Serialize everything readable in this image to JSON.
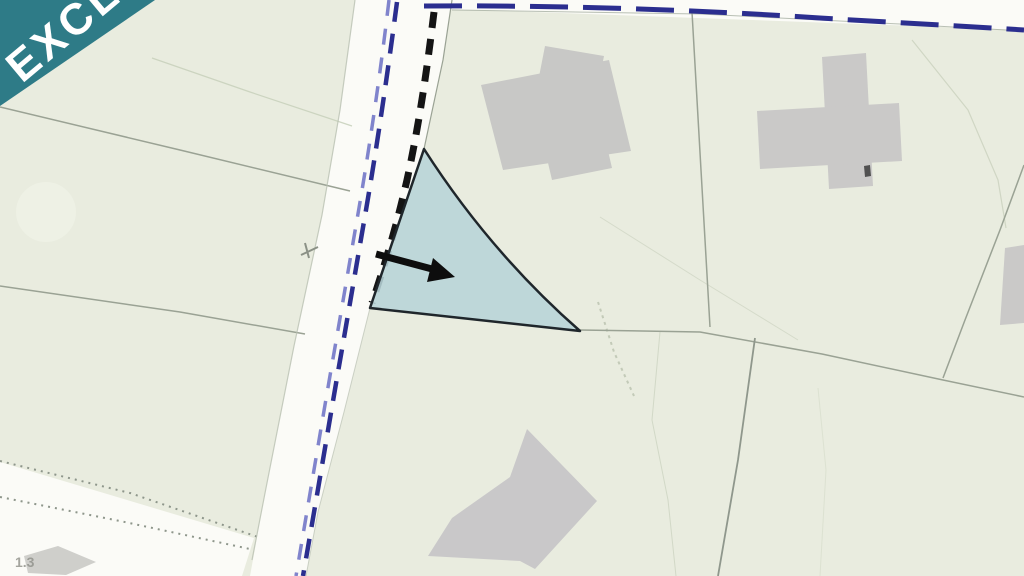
{
  "banner": {
    "label": "EXCL",
    "bg_color": "#2e7b87",
    "text_color": "#ffffff"
  },
  "map": {
    "viewbox": [
      0,
      0,
      1024,
      576
    ],
    "colors": {
      "land": "#e9ecdf",
      "road": "#fbfbf7",
      "building": "#c8c8c6",
      "parcel_highlight_fill": "#b7d4d8",
      "parcel_highlight_stroke": "#1f262b",
      "boundary_line": "#9aa294",
      "contour_line": "#c9d1bd",
      "route_blue_dark": "#2b2e8f",
      "route_blue_light": "#8084cc",
      "route_black": "#141414"
    },
    "corner_label": "1.3",
    "features": [
      {
        "name": "land-base",
        "kind": "polygon",
        "pts": [
          [
            0,
            0
          ],
          [
            1024,
            0
          ],
          [
            1024,
            576
          ],
          [
            0,
            576
          ]
        ],
        "f": "#e9ecdf"
      },
      {
        "name": "contour-blob",
        "kind": "circle",
        "cx": 46,
        "cy": 212,
        "r": 30,
        "f": "#eef1e5"
      },
      {
        "name": "road-main",
        "kind": "polygon",
        "pts": [
          [
            355,
            0
          ],
          [
            452,
            0
          ],
          [
            443,
            60
          ],
          [
            424,
            149
          ],
          [
            370,
            308
          ],
          [
            344,
            412
          ],
          [
            318,
            512
          ],
          [
            306,
            576
          ],
          [
            250,
            576
          ],
          [
            266,
            488
          ],
          [
            294,
            346
          ],
          [
            322,
            215
          ],
          [
            340,
            110
          ]
        ],
        "f": "#fbfbf7"
      },
      {
        "name": "road-branch",
        "kind": "polygon",
        "pts": [
          [
            0,
            462
          ],
          [
            254,
            538
          ],
          [
            242,
            576
          ],
          [
            0,
            576
          ]
        ],
        "f": "#fbfbf7"
      },
      {
        "name": "road-top-strip",
        "kind": "polygon",
        "pts": [
          [
            420,
            0
          ],
          [
            1024,
            0
          ],
          [
            1024,
            30
          ],
          [
            424,
            8
          ]
        ],
        "f": "#fbfbf7"
      },
      {
        "name": "contour-line-a",
        "kind": "polyline",
        "pts": [
          [
            152,
            58
          ],
          [
            250,
            92
          ],
          [
            352,
            126
          ]
        ],
        "s": "#c9d1bd",
        "w": 1.2,
        "o": 0.9
      },
      {
        "name": "contour-line-b",
        "kind": "polyline",
        "pts": [
          [
            600,
            217
          ],
          [
            700,
            280
          ],
          [
            798,
            340
          ]
        ],
        "s": "#ccd3c0",
        "w": 1,
        "o": 0.7
      },
      {
        "name": "contour-line-c",
        "kind": "polyline",
        "pts": [
          [
            912,
            40
          ],
          [
            968,
            110
          ],
          [
            998,
            180
          ],
          [
            1006,
            228
          ]
        ],
        "s": "#c9d1bd",
        "w": 1.2,
        "o": 0.8
      },
      {
        "name": "contour-line-d",
        "kind": "polyline",
        "pts": [
          [
            660,
            332
          ],
          [
            652,
            420
          ],
          [
            668,
            500
          ],
          [
            676,
            576
          ]
        ],
        "s": "#ccd3c0",
        "w": 1,
        "o": 0.8
      },
      {
        "name": "contour-hachure",
        "kind": "polyline",
        "pts": [
          [
            598,
            302
          ],
          [
            614,
            352
          ],
          [
            634,
            396
          ]
        ],
        "s": "#b9c2ae",
        "w": 2,
        "d": "3 4",
        "o": 0.8
      },
      {
        "name": "contour-line-e",
        "kind": "polyline",
        "pts": [
          [
            818,
            388
          ],
          [
            826,
            470
          ],
          [
            820,
            576
          ]
        ],
        "s": "#d4dac8",
        "w": 1,
        "o": 0.6
      },
      {
        "name": "boundary-left-upper",
        "kind": "polyline",
        "pts": [
          [
            0,
            107
          ],
          [
            180,
            150
          ],
          [
            350,
            191
          ]
        ],
        "s": "#9aa294",
        "w": 1.5
      },
      {
        "name": "boundary-left-lower",
        "kind": "polyline",
        "pts": [
          [
            0,
            286
          ],
          [
            180,
            312
          ],
          [
            305,
            334
          ]
        ],
        "s": "#9aa294",
        "w": 1.5
      },
      {
        "name": "boundary-branch-upper",
        "kind": "polyline",
        "pts": [
          [
            0,
            461
          ],
          [
            130,
            493
          ],
          [
            258,
            537
          ]
        ],
        "s": "#8e968b",
        "w": 2,
        "d": "2 5"
      },
      {
        "name": "boundary-branch-lower",
        "kind": "polyline",
        "pts": [
          [
            0,
            497
          ],
          [
            120,
            521
          ],
          [
            250,
            549
          ]
        ],
        "s": "#8e968b",
        "w": 2,
        "d": "2 5"
      },
      {
        "name": "boundary-top-green-edge",
        "kind": "polyline",
        "pts": [
          [
            452,
            10
          ],
          [
            700,
            14
          ],
          [
            900,
            24
          ],
          [
            1024,
            31
          ]
        ],
        "s": "#a8b0a2",
        "w": 1,
        "o": 0.8
      },
      {
        "name": "boundary-center-vertical",
        "kind": "polyline",
        "pts": [
          [
            692,
            12
          ],
          [
            701,
            170
          ],
          [
            710,
            327
          ]
        ],
        "s": "#9aa294",
        "w": 1.5
      },
      {
        "name": "boundary-east-diagonal",
        "kind": "polyline",
        "pts": [
          [
            1024,
            165
          ],
          [
            1000,
            230
          ],
          [
            965,
            320
          ],
          [
            943,
            378
          ]
        ],
        "s": "#9aa294",
        "w": 1.5
      },
      {
        "name": "boundary-mid-horizontal",
        "kind": "polyline",
        "pts": [
          [
            580,
            330
          ],
          [
            700,
            332
          ],
          [
            822,
            354
          ],
          [
            943,
            380
          ],
          [
            1024,
            397
          ]
        ],
        "s": "#9aa294",
        "w": 1.5
      },
      {
        "name": "boundary-south-vertical",
        "kind": "polyline",
        "pts": [
          [
            755,
            338
          ],
          [
            738,
            460
          ],
          [
            718,
            576
          ]
        ],
        "s": "#8f978c",
        "w": 1.8
      },
      {
        "name": "road-left-edge",
        "kind": "polyline",
        "pts": [
          [
            355,
            0
          ],
          [
            340,
            110
          ],
          [
            322,
            215
          ],
          [
            294,
            346
          ],
          [
            266,
            488
          ],
          [
            252,
            560
          ]
        ],
        "s": "#b9c0b2",
        "w": 1.2,
        "o": 0.8
      },
      {
        "name": "road-right-edge-upper",
        "kind": "polyline",
        "pts": [
          [
            452,
            0
          ],
          [
            443,
            60
          ],
          [
            424,
            149
          ]
        ],
        "s": "#9aa294",
        "w": 1.2
      },
      {
        "name": "road-right-edge-lower",
        "kind": "polyline",
        "pts": [
          [
            370,
            308
          ],
          [
            344,
            412
          ],
          [
            318,
            512
          ],
          [
            306,
            576
          ]
        ],
        "s": "#b9c0b2",
        "w": 1,
        "o": 0.7
      },
      {
        "name": "building-top-main",
        "kind": "polygon",
        "pts": [
          [
            481,
            85
          ],
          [
            609,
            60
          ],
          [
            631,
            151
          ],
          [
            503,
            170
          ]
        ],
        "f": "#c8c8c6"
      },
      {
        "name": "building-top-wing",
        "kind": "polygon",
        "pts": [
          [
            545,
            46
          ],
          [
            604,
            56
          ],
          [
            596,
            97
          ],
          [
            537,
            87
          ]
        ],
        "f": "#c8c8c6"
      },
      {
        "name": "building-top-ext",
        "kind": "polygon",
        "pts": [
          [
            545,
            150
          ],
          [
            605,
            138
          ],
          [
            612,
            168
          ],
          [
            552,
            180
          ]
        ],
        "f": "#c8c8c6"
      },
      {
        "name": "building-cross-vertical",
        "kind": "polygon",
        "pts": [
          [
            822,
            57
          ],
          [
            866,
            53
          ],
          [
            873,
            186
          ],
          [
            829,
            189
          ]
        ],
        "f": "#cac9c8"
      },
      {
        "name": "building-cross-horizontal",
        "kind": "polygon",
        "pts": [
          [
            757,
            111
          ],
          [
            899,
            103
          ],
          [
            902,
            161
          ],
          [
            760,
            169
          ]
        ],
        "f": "#cac9c8"
      },
      {
        "name": "building-cross-mark",
        "kind": "polygon",
        "pts": [
          [
            864,
            166
          ],
          [
            870,
            165
          ],
          [
            871,
            176
          ],
          [
            865,
            177
          ]
        ],
        "f": "#3c3c3c",
        "o": 0.85
      },
      {
        "name": "building-south-lshape",
        "kind": "polygon",
        "pts": [
          [
            527,
            429
          ],
          [
            510,
            477
          ],
          [
            452,
            518
          ],
          [
            428,
            556
          ],
          [
            520,
            561
          ],
          [
            535,
            569
          ],
          [
            597,
            501
          ]
        ],
        "f": "#c9c8c9"
      },
      {
        "name": "building-east-partial",
        "kind": "polygon",
        "pts": [
          [
            1005,
            248
          ],
          [
            1024,
            245
          ],
          [
            1024,
            323
          ],
          [
            1000,
            325
          ]
        ],
        "f": "#cac9c8"
      },
      {
        "name": "structure-corner-fragment",
        "kind": "polygon",
        "pts": [
          [
            24,
            556
          ],
          [
            58,
            546
          ],
          [
            96,
            562
          ],
          [
            66,
            575
          ],
          [
            28,
            573
          ]
        ],
        "f": "#c7c7c3",
        "o": 0.85
      },
      {
        "name": "boundary-blue-top-dashed",
        "kind": "path",
        "dd": "M424,6 C560,5 700,10 820,18 C900,23 980,27 1024,30",
        "s": "#2b2e8f",
        "w": 5,
        "d": "38 15"
      },
      {
        "name": "route-blue-light-dashed",
        "kind": "path",
        "dd": "M389,0 C381,68 371,138 359,208 C350,260 341,313 331,370 C323,416 311,488 296,576",
        "s": "#8084cc",
        "w": 3.5,
        "d": "16 13"
      },
      {
        "name": "route-blue-dark-dashed",
        "kind": "path",
        "dd": "M397,2 C388,70 378,140 366,210 C357,262 348,315 338,372 C330,418 318,490 303,576",
        "s": "#2b2e8f",
        "w": 4.5,
        "d": "20 12"
      },
      {
        "name": "route-black-dashed",
        "kind": "path",
        "dd": "M434,12 C427,70 419,125 407,180 C398,219 389,252 372,303",
        "s": "#141414",
        "w": 7,
        "d": "16 11"
      },
      {
        "name": "parcel-highlight",
        "kind": "path",
        "dd": "M424,149 L370,308 L580,331 Q490,252 424,149 Z",
        "f": "#b7d4d8",
        "s": "#1f262b",
        "w": 2.5,
        "fo": 0.88
      },
      {
        "name": "arrow-shaft",
        "kind": "path",
        "dd": "M376,254 L432,269",
        "s": "#0d0d0d",
        "w": 7
      },
      {
        "name": "arrow-head-icon",
        "kind": "polygon",
        "pts": [
          [
            455,
            277
          ],
          [
            433,
            258
          ],
          [
            427,
            282
          ]
        ],
        "f": "#0d0d0d"
      },
      {
        "name": "gate-tick",
        "kind": "path",
        "dd": "M301,255 L318,247 M305,243 L309,258",
        "s": "#8b9186",
        "w": 2
      },
      {
        "name": "corner-label",
        "kind": "text",
        "x": 15,
        "y": 567,
        "text": "1.3",
        "f": "#8f9089",
        "size": 14,
        "weight": "bold",
        "o": 0.8
      },
      {
        "name": "exclusivity-banner",
        "kind": "polygon",
        "pts": [
          [
            0,
            0
          ],
          [
            155,
            0
          ],
          [
            0,
            106
          ]
        ],
        "f": "#2e7b87"
      },
      {
        "name": "exclusivity-banner-text",
        "kind": "text",
        "x": 0,
        "y": 0,
        "transform": "translate(22,84) rotate(-40)",
        "text": "EXCL",
        "f": "#ffffff",
        "size": 44,
        "weight": "bold",
        "spacing": 4
      }
    ]
  }
}
